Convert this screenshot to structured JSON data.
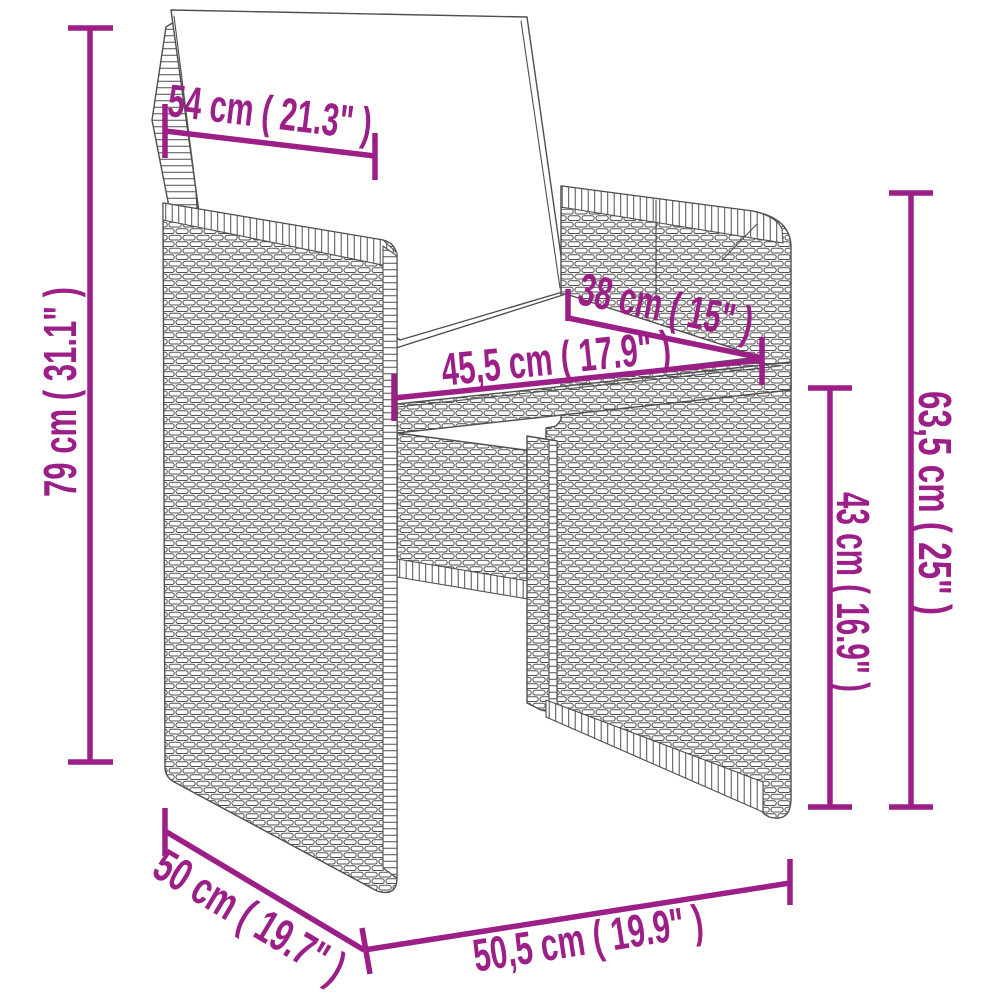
{
  "diagram": {
    "type": "product-dimension-diagram",
    "subject": "poly rattan garden chair with cushions",
    "accent_color": "#9C1F87",
    "line_color": "#4F4F4F",
    "background_color": "#FFFFFF",
    "dimensions": [
      {
        "id": "backrest-cushion-width",
        "label": "54 cm ( 21.3\" )"
      },
      {
        "id": "overall-height",
        "label": "79 cm ( 31.1\" )"
      },
      {
        "id": "seat-depth",
        "label": "38 cm ( 15\" )"
      },
      {
        "id": "seat-width",
        "label": "45,5 cm ( 17.9\" )"
      },
      {
        "id": "seat-height",
        "label": "43 cm ( 16.9\" )"
      },
      {
        "id": "armrest-height",
        "label": "63,5 cm ( 25\" )"
      },
      {
        "id": "overall-depth",
        "label": "50 cm ( 19.7\" )"
      },
      {
        "id": "overall-width",
        "label": "50,5 cm ( 19.9\" )"
      }
    ]
  }
}
